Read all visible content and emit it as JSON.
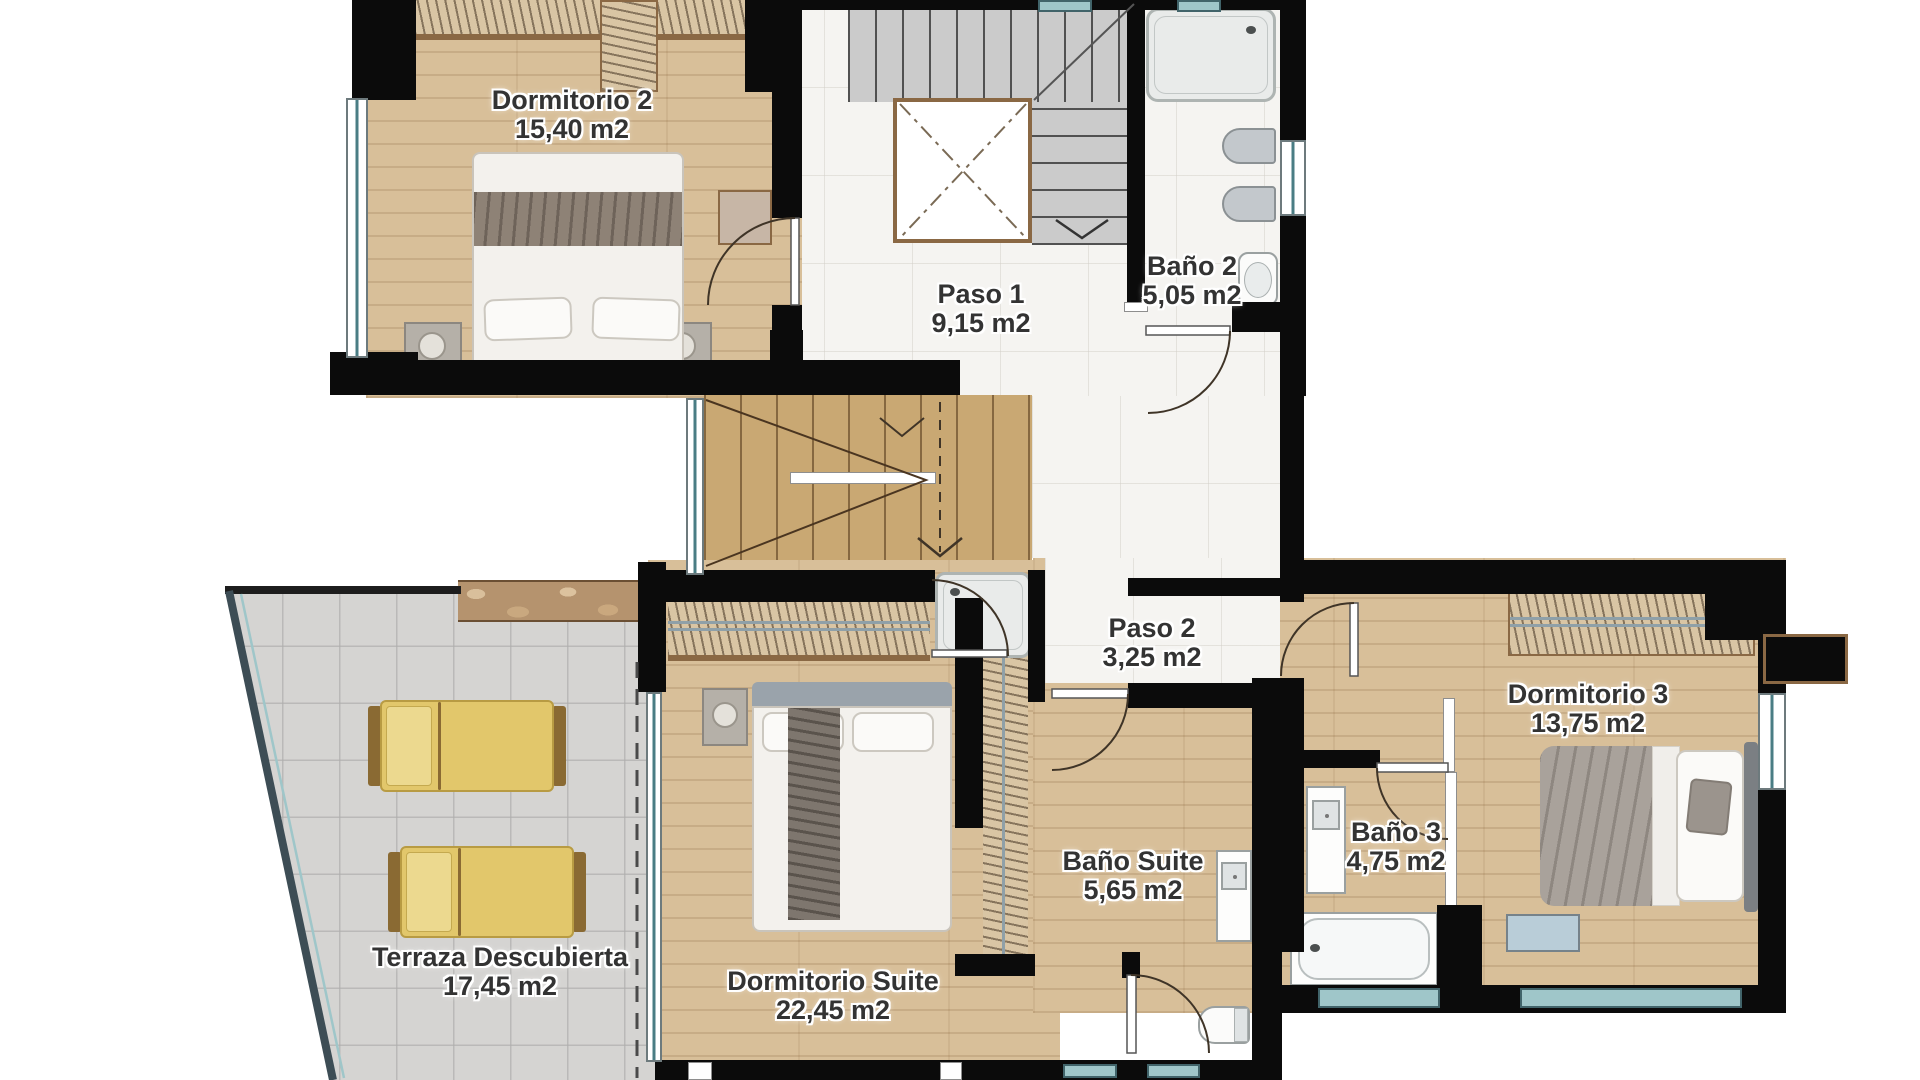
{
  "floorplan": {
    "rooms": [
      {
        "id": "dormitorio-2",
        "name": "Dormitorio 2",
        "area": "15,40 m2"
      },
      {
        "id": "paso-1",
        "name": "Paso 1",
        "area": "9,15 m2"
      },
      {
        "id": "bano-2",
        "name": "Baño 2",
        "area": "5,05 m2"
      },
      {
        "id": "paso-2",
        "name": "Paso 2",
        "area": "3,25 m2"
      },
      {
        "id": "dormitorio-3",
        "name": "Dormitorio 3",
        "area": "13,75 m2"
      },
      {
        "id": "bano-3",
        "name": "Baño 3",
        "area": "4,75 m2"
      },
      {
        "id": "bano-suite",
        "name": "Baño Suite",
        "area": "5,65 m2"
      },
      {
        "id": "dormitorio-suite",
        "name": "Dormitorio Suite",
        "area": "22,45 m2"
      },
      {
        "id": "terraza",
        "name": "Terraza Descubierta",
        "area": "17,45 m2"
      }
    ],
    "colors": {
      "wall": "#0b0b0b",
      "wood_floor": "#d8bf99",
      "stair_wood": "#c9a873",
      "marble_floor": "#f5f4f1",
      "terrace_tile": "#d5d4d2",
      "lounger_yellow": "#e2c76b",
      "window_teal": "#4a7d84",
      "door_trim_brown": "#8a6844",
      "label_text": "#333333"
    }
  }
}
